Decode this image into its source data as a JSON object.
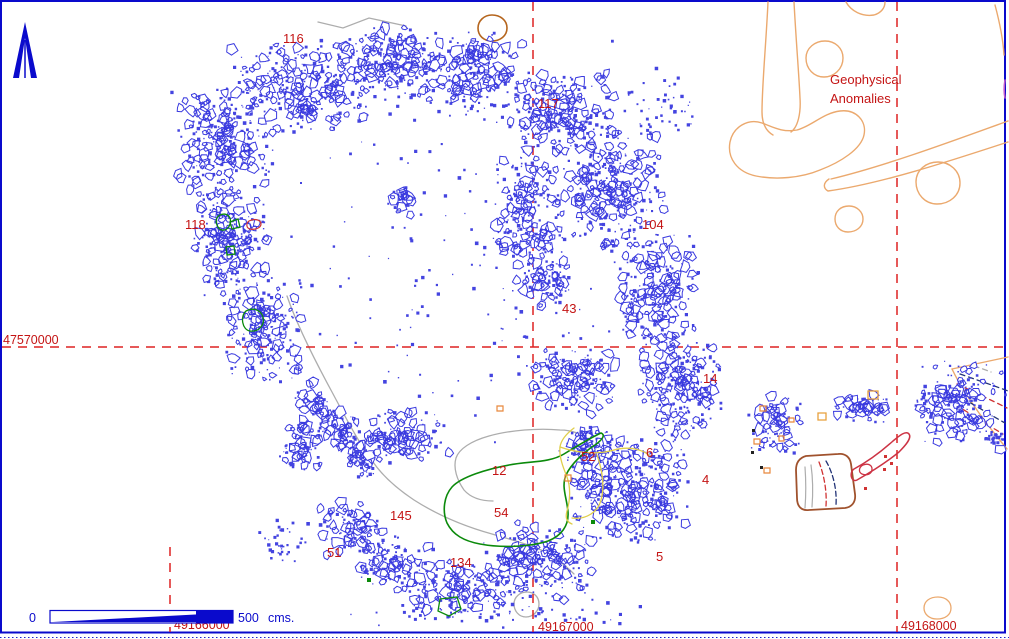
{
  "annotations": {
    "geophysical_line1": "Geophysical",
    "geophysical_line2": "Anomalies"
  },
  "scale_bar": {
    "zero_label": "0",
    "max_label": "500",
    "unit_label": "cms."
  },
  "grid": {
    "line_color": "#DD2222",
    "horizontal": {
      "label": "47570000",
      "y": 347,
      "x1": 2,
      "x2": 1007,
      "label_x": 3,
      "label_y": 344
    },
    "verticals": [
      {
        "label": "49166000",
        "x": 170,
        "y1": 547,
        "y2": 632,
        "label_x": 174,
        "label_y": 629
      },
      {
        "label": "49167000",
        "x": 533,
        "y1": 2,
        "y2": 632,
        "label_x": 538,
        "label_y": 631
      },
      {
        "label": "49168000",
        "x": 897,
        "y1": 2,
        "y2": 632,
        "label_x": 901,
        "label_y": 630
      }
    ]
  },
  "feature_labels": [
    {
      "text": "116",
      "x": 283,
      "y": 43
    },
    {
      "text": "117",
      "x": 538,
      "y": 108
    },
    {
      "text": "118",
      "x": 185,
      "y": 229
    },
    {
      "text": "104",
      "x": 642,
      "y": 229
    },
    {
      "text": "43",
      "x": 562,
      "y": 313
    },
    {
      "text": "14",
      "x": 703,
      "y": 383
    },
    {
      "text": "6",
      "x": 646,
      "y": 457
    },
    {
      "text": "52",
      "x": 581,
      "y": 461
    },
    {
      "text": "12",
      "x": 492,
      "y": 475
    },
    {
      "text": "4",
      "x": 702,
      "y": 484
    },
    {
      "text": "54",
      "x": 494,
      "y": 517
    },
    {
      "text": "145",
      "x": 390,
      "y": 520
    },
    {
      "text": "51",
      "x": 327,
      "y": 557
    },
    {
      "text": "134",
      "x": 450,
      "y": 567
    },
    {
      "text": "5",
      "x": 656,
      "y": 561
    }
  ],
  "colors": {
    "border_blue": "#0A0ACC",
    "rubble_fill": "#4444E0",
    "rubble_stroke": "#3A3ADF",
    "label_red": "#C41414",
    "anomaly_orange": "#EBA96E",
    "green": "#0B8A0B",
    "yellow": "#E0CE4A",
    "gray": "#ADADAD",
    "brown": "#A0522D",
    "navy": "#223377",
    "feature_red": "#CC3344"
  },
  "map": {
    "seed": 7,
    "scatter_clusters": [
      {
        "cx": 300,
        "cy": 85,
        "rx": 72,
        "ry": 48,
        "n": 300
      },
      {
        "cx": 390,
        "cy": 62,
        "rx": 60,
        "ry": 40,
        "n": 250
      },
      {
        "cx": 470,
        "cy": 72,
        "rx": 55,
        "ry": 45,
        "n": 230
      },
      {
        "cx": 555,
        "cy": 112,
        "rx": 62,
        "ry": 45,
        "n": 240
      },
      {
        "cx": 225,
        "cy": 142,
        "rx": 55,
        "ry": 65,
        "n": 290
      },
      {
        "cx": 230,
        "cy": 245,
        "rx": 40,
        "ry": 60,
        "n": 240
      },
      {
        "cx": 262,
        "cy": 330,
        "rx": 42,
        "ry": 55,
        "n": 200
      },
      {
        "type": "line",
        "x1": 303,
        "y1": 390,
        "x2": 370,
        "y2": 468,
        "jitter": 11,
        "n": 190
      },
      {
        "cx": 300,
        "cy": 445,
        "rx": 25,
        "ry": 35,
        "n": 80
      },
      {
        "cx": 610,
        "cy": 190,
        "rx": 55,
        "ry": 70,
        "n": 300
      },
      {
        "cx": 655,
        "cy": 290,
        "rx": 45,
        "ry": 65,
        "n": 260
      },
      {
        "cx": 680,
        "cy": 385,
        "rx": 42,
        "ry": 55,
        "n": 240
      },
      {
        "cx": 630,
        "cy": 485,
        "rx": 62,
        "ry": 58,
        "n": 400
      },
      {
        "cx": 585,
        "cy": 448,
        "rx": 30,
        "ry": 25,
        "n": 80
      },
      {
        "cx": 540,
        "cy": 562,
        "rx": 60,
        "ry": 40,
        "n": 240
      },
      {
        "cx": 460,
        "cy": 590,
        "rx": 60,
        "ry": 30,
        "n": 180
      },
      {
        "cx": 395,
        "cy": 565,
        "rx": 40,
        "ry": 30,
        "n": 130
      },
      {
        "cx": 350,
        "cy": 530,
        "rx": 35,
        "ry": 28,
        "n": 100
      },
      {
        "cx": 525,
        "cy": 220,
        "rx": 38,
        "ry": 70,
        "n": 190
      },
      {
        "cx": 545,
        "cy": 282,
        "rx": 30,
        "ry": 28,
        "n": 80
      },
      {
        "cx": 575,
        "cy": 380,
        "rx": 45,
        "ry": 35,
        "n": 170
      },
      {
        "cx": 400,
        "cy": 435,
        "rx": 55,
        "ry": 28,
        "n": 140
      },
      {
        "cx": 402,
        "cy": 200,
        "rx": 12,
        "ry": 16,
        "n": 30
      },
      {
        "cx": 450,
        "cy": 300,
        "rx": 190,
        "ry": 165,
        "n": 120,
        "dots": true
      },
      {
        "cx": 450,
        "cy": 120,
        "rx": 240,
        "ry": 90,
        "n": 60,
        "dots": true
      },
      {
        "cx": 660,
        "cy": 105,
        "rx": 40,
        "ry": 40,
        "n": 45,
        "dots": true
      },
      {
        "cx": 775,
        "cy": 425,
        "rx": 28,
        "ry": 32,
        "n": 100
      },
      {
        "cx": 862,
        "cy": 408,
        "rx": 30,
        "ry": 14,
        "n": 70
      },
      {
        "cx": 958,
        "cy": 405,
        "rx": 48,
        "ry": 48,
        "n": 180
      },
      {
        "cx": 992,
        "cy": 437,
        "rx": 12,
        "ry": 8,
        "n": 25,
        "dots": true
      },
      {
        "cx": 280,
        "cy": 540,
        "rx": 28,
        "ry": 22,
        "n": 35,
        "dots": true
      },
      {
        "cx": 490,
        "cy": 612,
        "rx": 170,
        "ry": 16,
        "n": 60,
        "dots": true
      }
    ],
    "vector_paths": [
      {
        "name": "anomaly-line-left",
        "z": "under",
        "d": "M768,2 C766,45 762,85 762,112 C762,124 766,131 773,135",
        "stroke": "#EBA96E",
        "w": 1.4
      },
      {
        "name": "anomaly-line-left2",
        "z": "under",
        "d": "M794,2 C796,40 799,75 800,98 C801,113 798,127 791,132",
        "stroke": "#EBA96E",
        "w": 1.4
      },
      {
        "name": "anomaly-circle-a",
        "z": "under",
        "d": "M825,41 C835,41 843,48 843,58 C843,69 834,77 824,77 C814,77 806,69 806,58 C806,48 815,41 825,41 Z",
        "stroke": "#EBA96E",
        "w": 1.4
      },
      {
        "name": "anomaly-arc-top",
        "z": "under",
        "d": "M846,2 C851,11 862,17 874,15 C881,13 885,8 885,2",
        "stroke": "#EBA96E",
        "w": 1.4
      },
      {
        "name": "anomaly-kidney",
        "z": "under",
        "d": "M762,123 C748,118 733,127 730,142 C727,158 737,172 756,176 C776,180 801,178 820,170 C841,162 861,149 864,135 C867,121 856,109 840,111 C823,113 812,126 797,130 C782,133 771,126 762,123 Z",
        "stroke": "#EBA96E",
        "w": 1.4
      },
      {
        "name": "anomaly-band-top",
        "z": "under",
        "d": "M831,179 C885,166 950,142 1008,121",
        "stroke": "#EBA96E",
        "w": 1.4
      },
      {
        "name": "anomaly-band-bottom",
        "z": "under",
        "d": "M829,179 C823,183 823,188 828,191 C880,184 950,161 1008,142",
        "stroke": "#EBA96E",
        "w": 1.4
      },
      {
        "name": "anomaly-circle-b",
        "z": "under",
        "d": "M938,162 C950,162 960,171 960,183 C960,195 950,204 937,204 C925,204 916,194 916,182 C916,170 926,162 938,162 Z",
        "stroke": "#EBA96E",
        "w": 1.4
      },
      {
        "name": "anomaly-circle-c",
        "z": "under",
        "d": "M849,206 C857,206 863,212 863,219 C863,227 856,232 848,232 C840,232 835,226 835,219 C835,211 841,206 849,206 Z",
        "stroke": "#EBA96E",
        "w": 1.4
      },
      {
        "name": "anomaly-edge-line",
        "z": "under",
        "d": "M995,5 C999,20 1003,38 1004,55",
        "stroke": "#EBA96E",
        "w": 1.4
      },
      {
        "name": "anomaly-ellipse-bottom",
        "z": "over",
        "d": "M938,597 C946,597 951,602 951,608 C951,615 945,619 937,619 C929,619 924,614 924,608 C924,601 930,597 938,597 Z",
        "stroke": "#EBA96E",
        "w": 1.3
      },
      {
        "name": "edge-mark-magenta",
        "z": "under",
        "d": "M1005,80 C1004,86 1004,93 1005,98",
        "stroke": "#C05ACD",
        "w": 1.6
      },
      {
        "name": "fan-top-border",
        "z": "under",
        "d": "M952,369 L1008,357",
        "stroke": "#EBA96E",
        "w": 1.4
      },
      {
        "name": "fan-outer-curve",
        "z": "under",
        "d": "M952,369 C963,392 983,420 1007,449",
        "stroke": "#EBA96E",
        "w": 1.4
      },
      {
        "name": "fan-gray-dash",
        "z": "under",
        "d": "M974,366 C980,368 986,370 991,372",
        "stroke": "#ADADAD",
        "w": 1.3,
        "dash": "5,4"
      },
      {
        "name": "fan-navy-dash-1",
        "z": "under",
        "d": "M960,374 C977,380 995,386 1008,391",
        "stroke": "#223377",
        "w": 1.3,
        "dash": "5,4"
      },
      {
        "name": "fan-red-dash-1",
        "z": "under",
        "d": "M957,384 C974,392 993,401 1007,408",
        "stroke": "#D03333",
        "w": 1.3,
        "dash": "5,4"
      },
      {
        "name": "fan-navy-dash-2",
        "z": "under",
        "d": "M955,394 C971,403 989,414 1005,423",
        "stroke": "#223377",
        "w": 1.3,
        "dash": "5,4"
      },
      {
        "name": "fan-red-dash-2",
        "z": "under",
        "d": "M956,405 C969,413 986,424 1003,434",
        "stroke": "#D03333",
        "w": 1.3,
        "dash": "5,4"
      },
      {
        "name": "trench-outline",
        "z": "under",
        "d": "M806,456 C799,458 796,463 796,470 L797,498 C797,506 801,511 809,510 L845,508 C852,507 856,502 855,494 L851,464 C850,457 845,453 838,454 Z",
        "stroke": "#A0522D",
        "w": 1.8
      },
      {
        "name": "trench-navy-dash",
        "z": "under",
        "d": "M826,461 C833,473 837,489 836,505",
        "stroke": "#223377",
        "w": 1.3,
        "dash": "5,3"
      },
      {
        "name": "trench-red-dash",
        "z": "under",
        "d": "M819,462 C824,475 827,491 826,506",
        "stroke": "#D03333",
        "w": 1.3,
        "dash": "5,3"
      },
      {
        "name": "trench-gray-line-1",
        "z": "under",
        "d": "M811,465 C813,479 813,494 812,507",
        "stroke": "#ADADAD",
        "w": 1.2
      },
      {
        "name": "trench-gray-line-2",
        "z": "under",
        "d": "M805,467 C806,481 806,495 805,508",
        "stroke": "#ADADAD",
        "w": 1.2
      },
      {
        "name": "brown-circle",
        "z": "under",
        "d": "M492,15 C500,15 507,20 507,28 C507,36 500,41 492,41 C484,41 478,36 478,28 C478,21 484,15 492,15",
        "stroke": "#B5651D",
        "w": 1.6
      },
      {
        "name": "gray-road-line",
        "z": "under",
        "d": "M287,296 C297,325 313,357 332,392 C349,424 362,448 373,462 C382,475 396,488 414,500 C436,514 463,526 492,534 C512,540 528,544 541,550 C554,556 566,566 574,574",
        "stroke": "#ADADAD",
        "w": 1.3
      },
      {
        "name": "gray-region-12",
        "z": "under",
        "d": "M589,441 C583,434 572,430 560,430 C539,428 510,430 489,436 C471,441 459,449 456,458 C453,468 457,480 464,490 C471,498 481,501 493,501",
        "stroke": "#ADADAD",
        "w": 1.3
      },
      {
        "name": "gray-zigzag-top",
        "z": "under",
        "d": "M318,22 L343,28 L369,18 L406,26",
        "stroke": "#ADADAD",
        "w": 1.3
      },
      {
        "name": "gray-circle-bottom",
        "z": "under",
        "d": "M527,592 C534,592 539,597 539,604 C539,611 533,617 526,617 C519,617 514,611 514,604 C514,597 520,592 527,592 Z",
        "stroke": "#ADADAD",
        "w": 1.3
      },
      {
        "name": "handle-outline",
        "z": "over",
        "d": "M854,469 C869,461 883,450 893,441 C899,436 906,430 909,434 C912,438 906,445 899,452 C888,461 871,472 857,480 C851,483 849,472 854,469 Z",
        "stroke": "#CC3344",
        "w": 1.5
      },
      {
        "name": "red-blob-small",
        "z": "over",
        "d": "M863,465 C868,463 872,465 872,469 C872,474 867,476 862,474 C858,472 859,467 863,465 Z",
        "stroke": "#CC3344",
        "w": 1.3
      },
      {
        "name": "red-dots",
        "z": "over",
        "d": "M884,455 h3 v3 h-3 Z M890,462 h3 v3 h-3 Z M883,468 h3 v3 h-3 Z M864,487 h3 v3 h-3 Z",
        "fill": "#D03333",
        "stroke": "none"
      },
      {
        "name": "green-region-54",
        "z": "over",
        "d": "M601,433 C590,438 577,446 564,454 C549,463 530,461 509,465 C487,469 461,477 452,487 C444,496 442,511 447,523 C453,535 464,541 480,544 C501,548 530,547 548,541 C561,536 569,526 568,512 C567,498 561,487 566,475 C571,464 584,452 595,445 C602,440 606,435 601,433 Z",
        "stroke": "#0B8A0B",
        "w": 1.6
      },
      {
        "name": "green-feature-a",
        "z": "over",
        "d": "M220,215 C227,212 232,217 230,224 C228,231 221,232 218,227 C215,222 216,217 220,215 Z",
        "stroke": "#0B8A0B",
        "w": 1.3
      },
      {
        "name": "green-feature-a2",
        "z": "over",
        "d": "M230,222 L238,219 L240,227 L232,229 Z",
        "stroke": "#0B8A0B",
        "w": 1.3
      },
      {
        "name": "green-feature-b",
        "z": "over",
        "d": "M226,247 L234,246 L235,254 L227,255 Z",
        "stroke": "#0B8A0B",
        "w": 1.3
      },
      {
        "name": "green-feature-c",
        "z": "over",
        "d": "M246,311 C253,307 261,310 263,317 C265,325 259,332 250,331 C242,330 240,316 246,311 Z",
        "stroke": "#0B8A0B",
        "w": 1.3
      },
      {
        "name": "green-feature-d",
        "z": "over",
        "d": "M440,599 L457,597 L461,609 L449,616 L438,611 Z",
        "stroke": "#0B8A0B",
        "w": 1.3
      },
      {
        "name": "green-dots",
        "z": "over",
        "d": "M367,578 h4 v4 h-4 Z M591,520 h4 v4 h-4 Z",
        "fill": "#0B8A0B",
        "stroke": "none"
      },
      {
        "name": "red-feature-118",
        "z": "over",
        "d": "M249,221 C255,218 261,220 261,224 C261,228 255,230 250,229 C246,228 246,223 249,221 Z",
        "stroke": "#D03333",
        "w": 1.2
      },
      {
        "name": "yellow-region-52a",
        "z": "over",
        "d": "M574,428 C566,434 561,440 560,447 C559,457 563,467 567,477 C571,488 570,501 567,511 C565,518 567,522 572,524",
        "stroke": "#E0CE4A",
        "w": 1.3
      },
      {
        "name": "yellow-region-52b",
        "z": "over",
        "d": "M560,447 C577,453 597,455 614,450 C628,446 641,449 649,455",
        "stroke": "#E0CE4A",
        "w": 1.3
      },
      {
        "name": "yellow-region-52c",
        "z": "over",
        "d": "M597,455 C602,469 605,486 601,500 C598,512 586,520 572,518",
        "stroke": "#E0CE4A",
        "w": 1.3
      },
      {
        "name": "yellow-square-1",
        "z": "over",
        "d": "M868,391 h10 v8 h-10 Z",
        "stroke": "#E8A03C",
        "w": 1.3
      },
      {
        "name": "yellow-square-2",
        "z": "over",
        "d": "M818,413 h8 v7 h-8 Z",
        "stroke": "#E8A03C",
        "w": 1.3
      },
      {
        "name": "black-marks",
        "z": "over",
        "d": "M752,429 h3 v3 h-3 Z M751,451 h3 v3 h-3 Z M760,466 h3 v3 h-3 Z",
        "fill": "#222222",
        "stroke": "none"
      },
      {
        "name": "orange-marks",
        "z": "over",
        "d": "M760,406 h6 v5 h-6 Z M754,439 h6 v5 h-6 Z M764,468 h6 v5 h-6 Z M779,436 h5 v5 h-5 Z M497,406 h6 v5 h-6 Z M565,475 h6 v6 h-6 Z M789,418 h5 v4 h-5 Z",
        "stroke": "#E8883C",
        "fill": "none",
        "w": 1.2
      }
    ]
  }
}
